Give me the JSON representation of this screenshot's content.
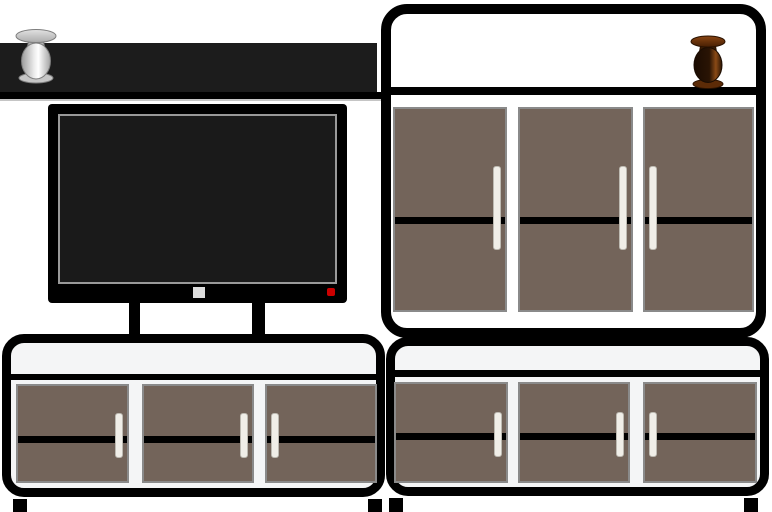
{
  "scene": {
    "label": "Vector illustration of a living-room wall unit: wall shelf with a silver vase, flat-screen TV on stand legs, tall three-door cabinet with a brown wooden vase, and two low three-door sideboards on block feet",
    "objects": {
      "wall_shelf": {
        "label": "Wall shelf"
      },
      "silver_vase": {
        "label": "Silver vase on wall shelf"
      },
      "tv": {
        "label": "Flat-screen TV"
      },
      "tv_screen": {
        "label": "TV screen"
      },
      "tv_power_button": {
        "label": "TV power button"
      },
      "tv_standby_led": {
        "label": "TV standby LED"
      },
      "tv_legs": {
        "label": "TV stand legs"
      },
      "tall_cabinet": {
        "label": "Tall cabinet with three brown doors"
      },
      "brown_vase": {
        "label": "Brown wooden vase on tall cabinet shelf"
      },
      "left_sideboard": {
        "label": "Left low sideboard with three brown doors"
      },
      "right_sideboard": {
        "label": "Right low sideboard with three brown doors"
      },
      "cabinet_door": {
        "label": "Brown cabinet door"
      },
      "door_handle": {
        "label": "White door handle"
      },
      "foot": {
        "label": "Black block foot"
      }
    },
    "palette": {
      "outline_black": "#000000",
      "shelf_dark": "#1c1c1c",
      "screen_dark": "#1a1a1a",
      "screen_border_gray": "#999999",
      "door_brown": "#73645a",
      "door_border_gray": "#8a8a8a",
      "handle_white": "#f0eee8",
      "tall_cabinet_interior": "#ffffff",
      "sideboard_interior": "#f4f5f6",
      "standby_led_red": "#cc0000",
      "power_button_gray": "#dcdcdc",
      "silver_vase_gray": "#c0c0c0",
      "brown_vase_dark": "#3a1d06"
    }
  }
}
